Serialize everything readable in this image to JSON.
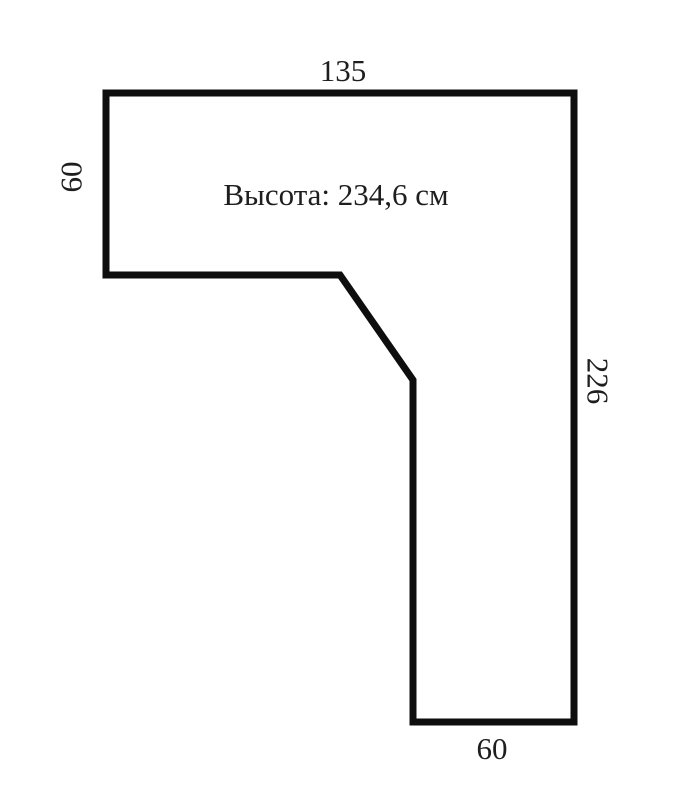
{
  "figure": {
    "type": "dimension-drawing",
    "description_note": "Высота: 234,6 см",
    "dimensions": {
      "top": "135",
      "left": "60",
      "right": "226",
      "bottom": "60"
    },
    "shape": {
      "kind": "L-shape with beveled inner corner",
      "outline_points": "106,93 574,93 574,722 413,722 413,380 340,275 106,275"
    }
  },
  "colors": {
    "outline": "#0e0e0e",
    "text": "#1e1e1e",
    "background": "#ffffff"
  }
}
